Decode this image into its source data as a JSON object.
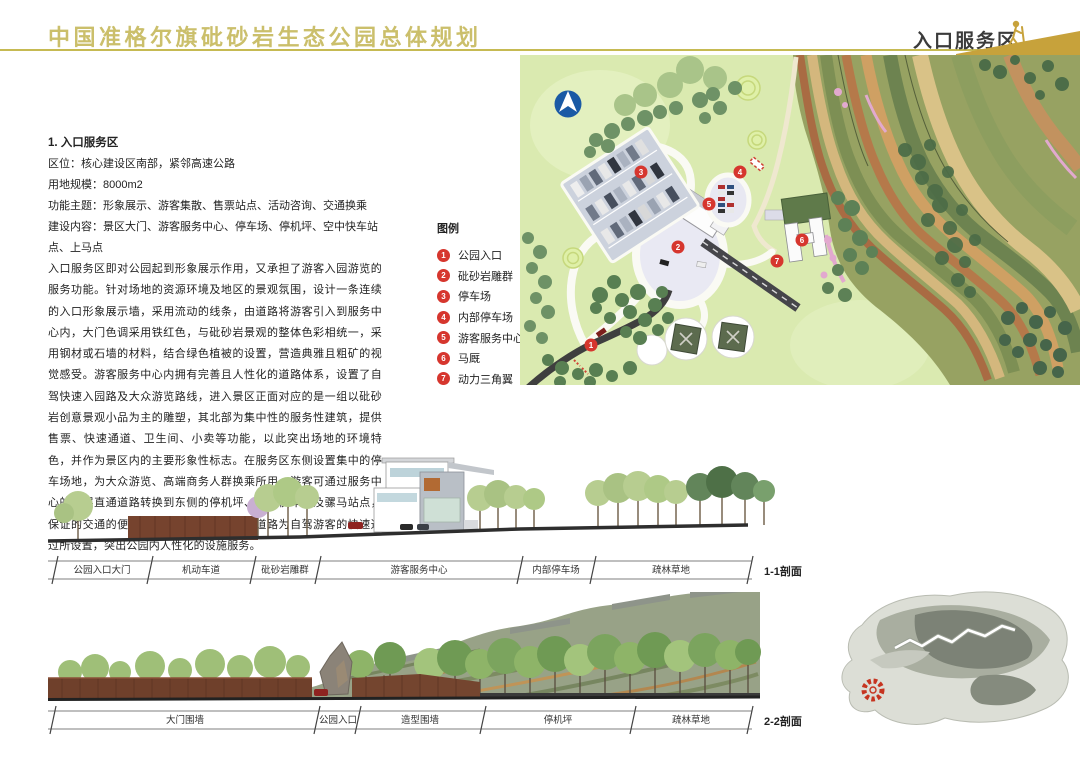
{
  "header": {
    "title": "中国准格尔旗砒砂岩生态公园总体规划",
    "section_label": "入口服务区",
    "gold_accent": "#c7a23b",
    "title_gold": "#cbbf6b"
  },
  "info": {
    "heading": "1.  入口服务区",
    "line1": "区位：核心建设区南部，紧邻高速公路",
    "line2": "用地规模：8000m2",
    "line3": "功能主题：形象展示、游客集散、售票站点、活动咨询、交通换乘",
    "line4": "建设内容：景区大门、游客服务中心、停车场、停机坪、空中快车站点、上马点",
    "body": "入口服务区即对公园起到形象展示作用，又承担了游客入园游览的服务功能。针对场地的资源环境及地区的景观氛围，设计一条连续的入口形象展示墙，采用流动的线条，由道路将游客引入到服务中心内，大门色调采用铁红色，与砒砂岩景观的整体色彩相统一，采用钢材或石墙的材料，结合绿色植被的设置，营造典雅且粗矿的视觉感受。游客服务中心内拥有完善且人性化的道路体系，设置了自驾快速入园路及大众游览路线，进入景区正面对应的是一组以砒砂岩创意景观小品为主的雕塑，其北部为集中性的服务性建筑，提供售票、快速通道、卫生间、小卖等功能，以此突出场地的环境特色，并作为景区内的主要形象性标志。在服务区东侧设置集中的停车场地，为大众游览、高端商务人群换乘所用。游客可通过服务中心的二层直通道路转换到东侧的停机坪、空中快车线及骡马站点，保证的交通的便捷性。同时，在游客环形道路为自驾游客的快速通过所设置，突出公园内人性化的设施服务。"
  },
  "legend": {
    "title": "图例",
    "marker_color": "#d6362e",
    "items": [
      {
        "num": "1",
        "label": "公园入口"
      },
      {
        "num": "2",
        "label": "砒砂岩雕群"
      },
      {
        "num": "3",
        "label": "停车场"
      },
      {
        "num": "4",
        "label": "内部停车场"
      },
      {
        "num": "5",
        "label": "游客服务中心"
      },
      {
        "num": "6",
        "label": "马厩"
      },
      {
        "num": "7",
        "label": "动力三角翼"
      }
    ]
  },
  "sections": {
    "s11": {
      "name": "1-1剖面",
      "segments": [
        "公园入口大门",
        "机动车道",
        "砒砂岩雕群",
        "游客服务中心",
        "内部停车场",
        "疏林草地"
      ]
    },
    "s22": {
      "name": "2-2剖面",
      "segments": [
        "大门围墙",
        "公园入口",
        "造型围墙",
        "停机坪",
        "疏林草地"
      ]
    }
  }
}
